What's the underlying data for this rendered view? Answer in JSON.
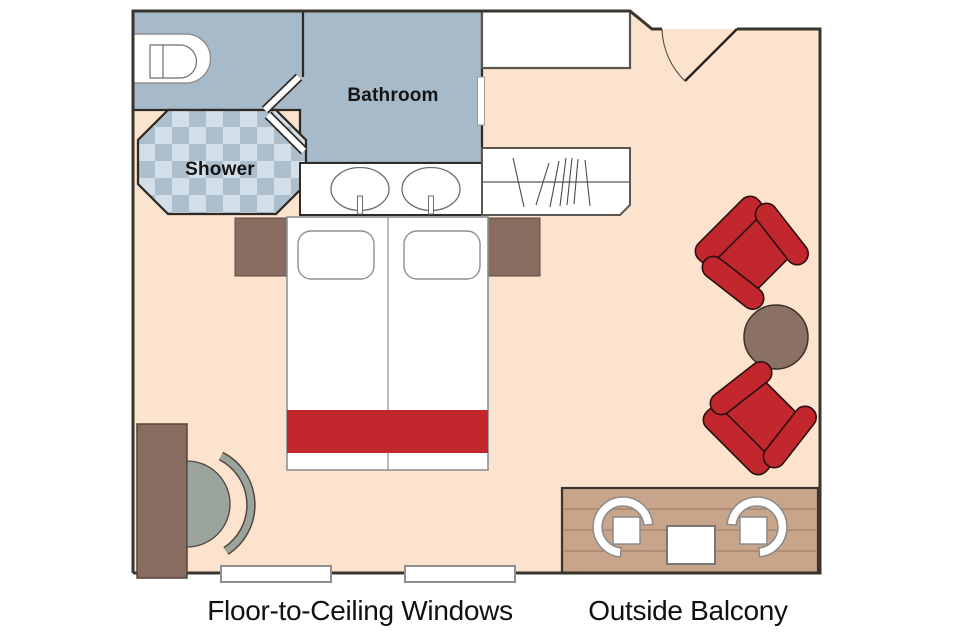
{
  "diagram": {
    "type": "cruise-cabin-floor-plan",
    "labels": {
      "bathroom": "Bathroom",
      "shower": "Shower",
      "windows_caption": "Floor-to-Ceiling Windows",
      "balcony_caption": "Outside Balcony"
    },
    "areas": [
      "bathroom",
      "shower",
      "toilet-area",
      "main-cabin",
      "entry",
      "outside-balcony"
    ],
    "furniture": [
      "toilet",
      "shower-pan",
      "double-sink-vanity",
      "overhead-cabinet",
      "wardrobe-with-hangers",
      "sliding-bathroom-door",
      "entry-door",
      "double-bed",
      "pillows",
      "bed-runner",
      "nightstand-left",
      "nightstand-right",
      "desk",
      "desk-chair",
      "armchair-top",
      "armchair-bottom",
      "round-side-table",
      "balcony-deck",
      "balcony-chair-left",
      "balcony-chair-right",
      "balcony-table",
      "floor-window-left",
      "floor-window-right"
    ],
    "colors": {
      "floor": "#fbe3cd",
      "bathroom_blue": "#a7bac9",
      "checker_light": "#d2dfe8",
      "checker_dark": "#adbfcd",
      "accent_red": "#c1272d",
      "wood_brown": "#8a6b5f",
      "table_brown": "#8b7164",
      "deck_tan": "#c8a48a",
      "deck_line": "#a7866e",
      "chair_gray": "#9aa39c",
      "white": "#ffffff"
    }
  }
}
